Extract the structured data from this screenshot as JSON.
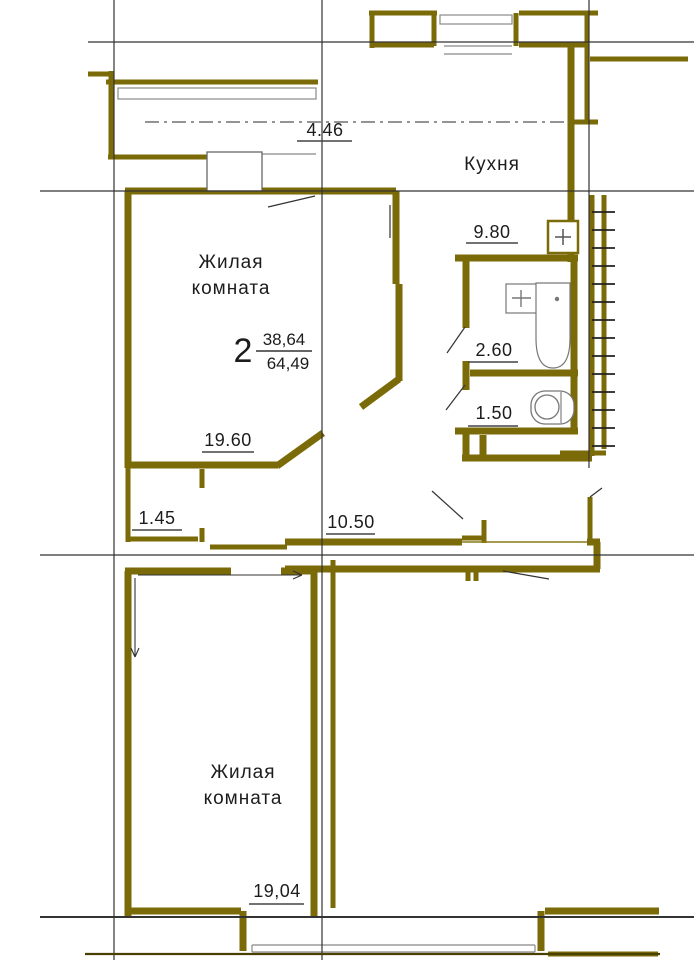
{
  "apartment": {
    "summary": {
      "rooms": "2",
      "living_area": "38,64",
      "total_area": "64,49"
    },
    "rooms": {
      "kitchen": {
        "label": "Кухня",
        "area": "9.80"
      },
      "living_room_top": {
        "label_line1": "Жилая",
        "label_line2": "комната",
        "area": "19.60"
      },
      "living_room_bottom": {
        "label_line1": "Жилая",
        "label_line2": "комната",
        "area": "19,04"
      },
      "bathroom": {
        "area": "2.60"
      },
      "toilet": {
        "area": "1.50"
      },
      "hallway": {
        "area": "10.50"
      },
      "loggia": {
        "area": "4.46"
      },
      "wardrobe_niche": {
        "area": "1.45"
      }
    },
    "colors": {
      "walls": "#7b6a08",
      "axis_lines": "#333333",
      "text": "#1c1c1c",
      "fixtures": "#777777",
      "background": "#ffffff"
    }
  }
}
